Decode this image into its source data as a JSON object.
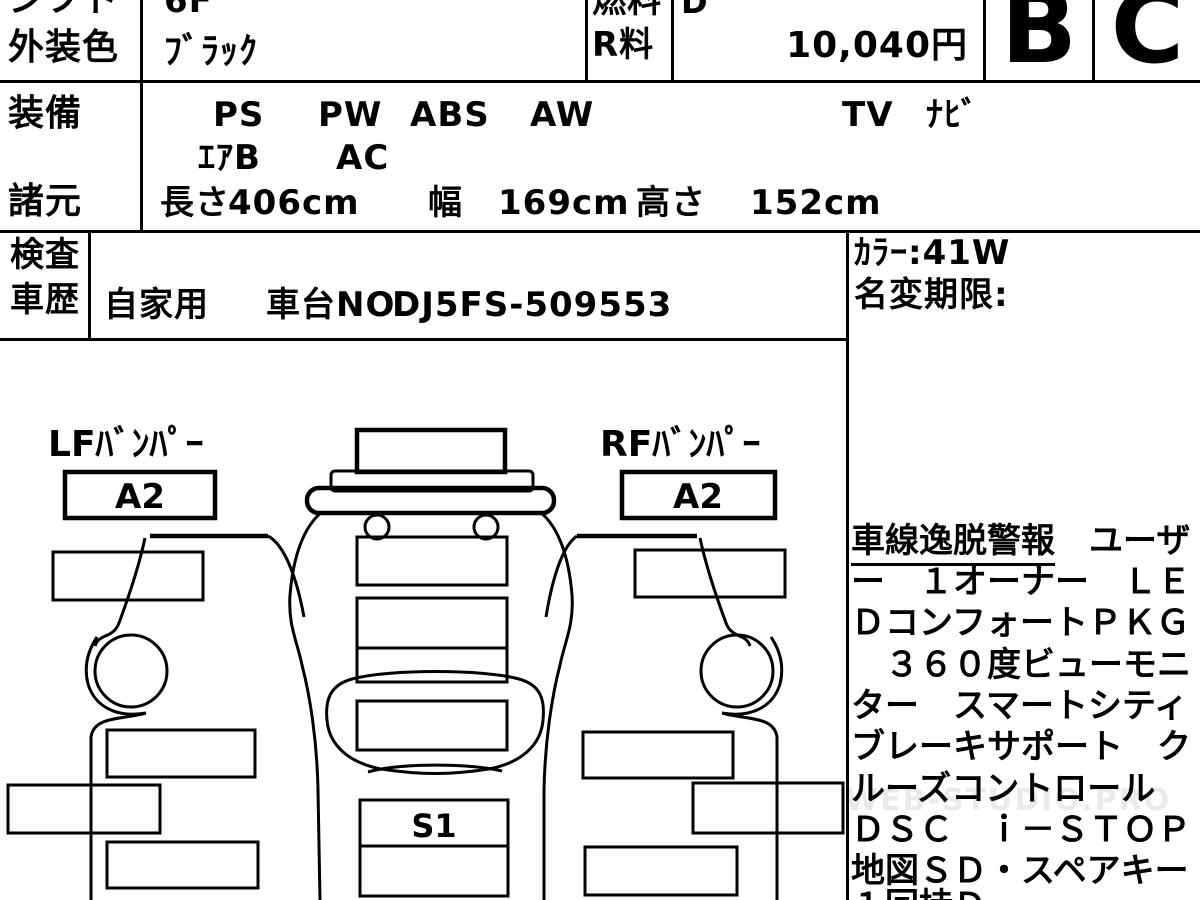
{
  "header": {
    "shift": {
      "label": "シフト",
      "value": "6F"
    },
    "exterior_color": {
      "label": "外装色",
      "value": "ﾌﾞﾗｯｸ"
    },
    "fuel": {
      "label": "燃料",
      "value": "D"
    },
    "r_fee": {
      "label": "R料",
      "value": "10,040円"
    },
    "exterior_grade": "B",
    "interior_grade": "C",
    "equipment": {
      "label": "装備",
      "items_line1": [
        "PS",
        "PW",
        "ABS",
        "AW",
        "TV",
        "ﾅﾋﾞ"
      ],
      "items_line2": [
        "ｴｱB",
        "AC"
      ]
    },
    "specs": {
      "label": "諸元",
      "length_label": "長さ",
      "length_value": "406cm",
      "width_label": "幅",
      "width_value": "169cm",
      "height_label": "高さ",
      "height_value": "152cm"
    },
    "inspection_label": "検査",
    "history_label": "車歴",
    "history": {
      "usage": "自家用",
      "chassis_label": "車台NO",
      "chassis_no": "DJ5FS-509553"
    }
  },
  "right_column": {
    "color_code": "ｶﾗｰ:41W",
    "name_change_label": "名変期限:",
    "notes": {
      "underlined": "車線逸脱警報",
      "line1_rest": "　ユーザ",
      "lines": [
        "ー　１オーナー　ＬＥ",
        "ＤコンフォートＰＫＧ",
        "　３６０度ビューモニ",
        "ター　スマートシティ",
        "ブレーキサポート　ク",
        "ルーズコントロール",
        "ＤＳＣ　ｉ－ＳＴＯＰ",
        "地図ＳＤ・スペアキー"
      ],
      "partial_last_line": "１回持Ｄ"
    },
    "watermark": "WEB-STUDIO.PRO"
  },
  "diagram": {
    "lf_bumper_label": "LFﾊﾞﾝﾊﾟｰ",
    "lf_bumper_code": "A2",
    "rf_bumper_label": "RFﾊﾞﾝﾊﾟｰ",
    "rf_bumper_code": "A2",
    "sill_code": "S1"
  }
}
